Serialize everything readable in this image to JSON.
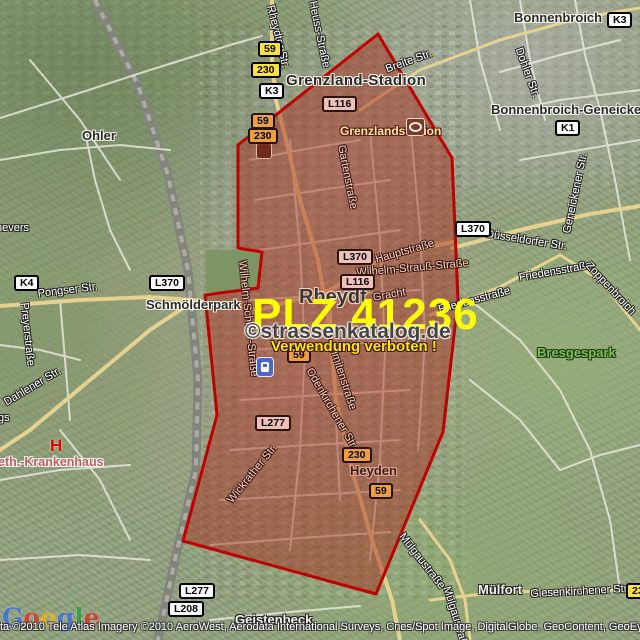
{
  "overlay": {
    "plz": "PLZ 41236",
    "watermark": "©strassenkatalog.de",
    "warning": "Verwendung verboten !"
  },
  "zone": {
    "points": "378,34 452,158 458,300 443,432 376,594 183,541 217,415 205,295 258,288 262,252 238,248 238,145",
    "fill": "rgba(168,42,28,0.48)",
    "border": "#BE0000"
  },
  "shields": [
    {
      "label": "59",
      "x": 258,
      "y": 41,
      "style": "yellow"
    },
    {
      "label": "230",
      "x": 251,
      "y": 62,
      "style": "yellow"
    },
    {
      "label": "K3",
      "x": 259,
      "y": 83,
      "style": "white"
    },
    {
      "label": "59",
      "x": 251,
      "y": 113,
      "style": "orange"
    },
    {
      "label": "230",
      "x": 248,
      "y": 128,
      "style": "orange"
    },
    {
      "label": "K3",
      "x": 607,
      "y": 12,
      "style": "white"
    },
    {
      "label": "K1",
      "x": 555,
      "y": 120,
      "style": "white"
    },
    {
      "label": "L116",
      "x": 322,
      "y": 96,
      "style": "pink"
    },
    {
      "label": "L370",
      "x": 455,
      "y": 221,
      "style": "white"
    },
    {
      "label": "L370",
      "x": 337,
      "y": 249,
      "style": "pink"
    },
    {
      "label": "L116",
      "x": 340,
      "y": 274,
      "style": "pink"
    },
    {
      "label": "59",
      "x": 287,
      "y": 347,
      "style": "orange"
    },
    {
      "label": "230",
      "x": 342,
      "y": 447,
      "style": "orange"
    },
    {
      "label": "59",
      "x": 369,
      "y": 483,
      "style": "orange"
    },
    {
      "label": "L277",
      "x": 255,
      "y": 415,
      "style": "pink"
    },
    {
      "label": "L277",
      "x": 179,
      "y": 583,
      "style": "white"
    },
    {
      "label": "L208",
      "x": 168,
      "y": 601,
      "style": "white"
    },
    {
      "label": "230",
      "x": 626,
      "y": 583,
      "style": "yellow"
    },
    {
      "label": "K4",
      "x": 14,
      "y": 275,
      "style": "white"
    },
    {
      "label": "L370",
      "x": 149,
      "y": 275,
      "style": "white"
    }
  ],
  "streets": [
    {
      "name": "Rheydter Str.",
      "x": 276,
      "y": 4,
      "rot": 76,
      "zone": false
    },
    {
      "name": "Heuss-Straße",
      "x": 318,
      "y": 0,
      "rot": 78,
      "zone": false
    },
    {
      "name": "Breite Str.",
      "x": 384,
      "y": 64,
      "rot": -20,
      "zone": false
    },
    {
      "name": "Dohler Str.",
      "x": 524,
      "y": 46,
      "rot": 70,
      "zone": false
    },
    {
      "name": "Düsseldorfer Str.",
      "x": 487,
      "y": 228,
      "rot": 9,
      "zone": false
    },
    {
      "name": "Geneickener Str.",
      "x": 561,
      "y": 232,
      "rot": -78,
      "zone": false
    },
    {
      "name": "Friedensstraße",
      "x": 518,
      "y": 272,
      "rot": -10,
      "zone": false
    },
    {
      "name": "Friedensstraße",
      "x": 437,
      "y": 304,
      "rot": -15,
      "zone": false
    },
    {
      "name": "Zoppenbroich",
      "x": 592,
      "y": 260,
      "rot": 47,
      "zone": false
    },
    {
      "name": "Pongser Str.",
      "x": 37,
      "y": 288,
      "rot": -7,
      "zone": false
    },
    {
      "name": "Preyerstraße",
      "x": 30,
      "y": 302,
      "rot": 84,
      "zone": false
    },
    {
      "name": "Dahlener Str.",
      "x": 2,
      "y": 398,
      "rot": -31,
      "zone": false
    },
    {
      "name": "Mülgaustraße",
      "x": 406,
      "y": 531,
      "rot": 52,
      "zone": false
    },
    {
      "name": "Mülgaustraße",
      "x": 452,
      "y": 585,
      "rot": 73,
      "zone": false
    },
    {
      "name": "Giesenkirchener Str.",
      "x": 530,
      "y": 588,
      "rot": -3,
      "zone": false
    },
    {
      "name": "nevers",
      "x": -4,
      "y": 222,
      "rot": 0,
      "zone": false
    },
    {
      "name": "gs",
      "x": -2,
      "y": 412,
      "rot": 0,
      "zone": false
    },
    {
      "name": "Gartenstraße",
      "x": 347,
      "y": 144,
      "rot": 79,
      "zone": true
    },
    {
      "name": "Hauptstraße",
      "x": 374,
      "y": 254,
      "rot": -16,
      "zone": true
    },
    {
      "name": "Wilhelm-Strauß-Straße",
      "x": 356,
      "y": 267,
      "rot": -5,
      "zone": true
    },
    {
      "name": "Gracht",
      "x": 372,
      "y": 292,
      "rot": -10,
      "zone": true
    },
    {
      "name": "Limitenstraße",
      "x": 338,
      "y": 344,
      "rot": 72,
      "zone": true
    },
    {
      "name": "Odenkirchener Str.",
      "x": 314,
      "y": 366,
      "rot": 60,
      "zone": true
    },
    {
      "name": "Wickrather Str.",
      "x": 225,
      "y": 498,
      "rot": -51,
      "zone": true
    },
    {
      "name": "Wilhelm-Schiffer-Straße",
      "x": 248,
      "y": 260,
      "rot": 84,
      "zone": true
    }
  ],
  "places": [
    {
      "name": "Ohler",
      "x": 82,
      "y": 128,
      "style": "town"
    },
    {
      "name": "Grenzland-Stadion",
      "x": 286,
      "y": 72,
      "style": "district"
    },
    {
      "name": "Bonnenbroich",
      "x": 514,
      "y": 10,
      "style": "town"
    },
    {
      "name": "Bonnenbroich-Geneicken",
      "x": 491,
      "y": 102,
      "style": "town"
    },
    {
      "name": "Schmölderpark",
      "x": 146,
      "y": 297,
      "style": "town"
    },
    {
      "name": "Rheydt",
      "x": 299,
      "y": 286,
      "style": "city"
    },
    {
      "name": "Heyden",
      "x": 350,
      "y": 463,
      "style": "zone-town"
    },
    {
      "name": "Geistenbeck",
      "x": 235,
      "y": 612,
      "style": "minor"
    },
    {
      "name": "Mülfort",
      "x": 478,
      "y": 582,
      "style": "minor"
    },
    {
      "name": "Bresgespark",
      "x": 537,
      "y": 345,
      "style": "park"
    },
    {
      "name": "Grenzlandstadion",
      "x": 340,
      "y": 124,
      "style": "poi"
    },
    {
      "name": "eth.-Krankenhaus",
      "x": -2,
      "y": 455,
      "style": "hospital"
    }
  ],
  "pois": {
    "hospital_letter": "H",
    "icons": [
      "train-station-icon",
      "stadium-icon",
      "poi-icon",
      "hospital-icon"
    ]
  },
  "google": {
    "letters": [
      {
        "ch": "G",
        "color": "#3B6BE0"
      },
      {
        "ch": "o",
        "color": "#D93025"
      },
      {
        "ch": "o",
        "color": "#F4B400"
      },
      {
        "ch": "g",
        "color": "#3B6BE0"
      },
      {
        "ch": "l",
        "color": "#1E9E3E"
      },
      {
        "ch": "e",
        "color": "#D93025"
      }
    ]
  },
  "attribution": "ta ©2010 Tele Atlas  Imagery ©2010 AeroWest, Aerodata International Surveys, Cnes/Spot Image, DigitalGlobe, GeoContent, GeoEye",
  "colors": {
    "zone_fill": "#A82A1C",
    "zone_border": "#BE0000",
    "shield_yellow": "#FFE13D",
    "shield_orange": "#EE9E3E",
    "shield_white": "#FFFFFF",
    "shield_pink": "#EFC0BA",
    "plz_text": "#FFFF00",
    "warning_text": "#FFE500"
  }
}
